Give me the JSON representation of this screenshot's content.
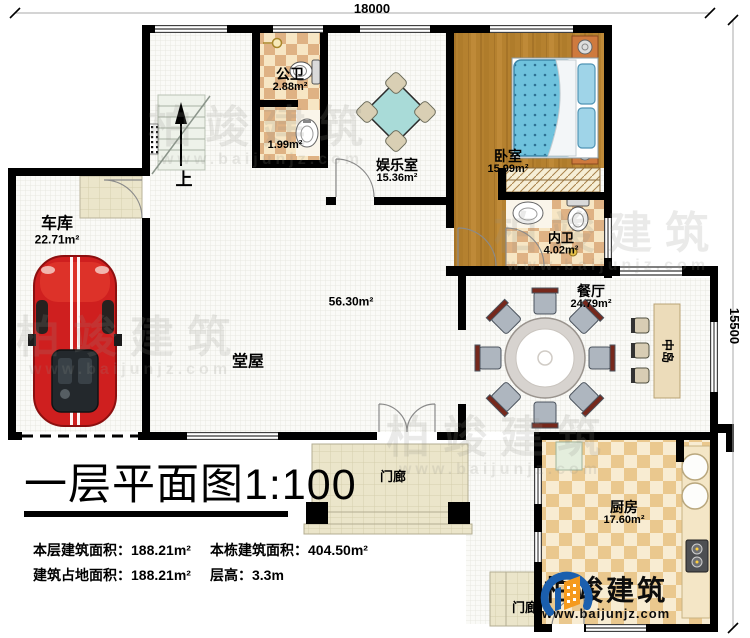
{
  "dimensions": {
    "top": "18000",
    "right": "15500"
  },
  "plan_title": {
    "text": "一层平面图",
    "scale": "1:100"
  },
  "stair": {
    "up": "上"
  },
  "rooms": {
    "garage": {
      "name": "车库",
      "area": "22.71m²"
    },
    "public_bath": {
      "name": "公卫",
      "area": "2.88m²"
    },
    "wash_alcove": {
      "area": "1.99m²"
    },
    "entertainment": {
      "name": "娱乐室",
      "area": "15.36m²"
    },
    "bedroom": {
      "name": "卧室",
      "area": "15.99m²"
    },
    "ensuite": {
      "name": "内卫",
      "area": "4.02m²"
    },
    "dining": {
      "name": "餐厅",
      "area": "24.79m²"
    },
    "hall": {
      "name": "堂屋",
      "area": "56.30m²"
    },
    "island": {
      "name": "中岛"
    },
    "kitchen": {
      "name": "厨房",
      "area": "17.60m²"
    },
    "porch_front": {
      "name": "门廊"
    },
    "porch_side": {
      "name": "门廊"
    }
  },
  "stats": {
    "floor_area": {
      "label": "本层建筑面积：",
      "value": "188.21m²"
    },
    "footprint": {
      "label": "建筑占地面积：",
      "value": "188.21m²"
    },
    "total_area": {
      "label": "本栋建筑面积：",
      "value": "404.50m²"
    },
    "story_height": {
      "label": "层高：",
      "value": "3.3m"
    }
  },
  "brand": {
    "name": "柏竣建筑",
    "url": "www.baijunjz.com"
  },
  "watermark": {
    "text": "柏竣建筑",
    "url": "www.baijunjz.com"
  },
  "colors": {
    "wall": "#000000",
    "accent_blue": "#1b5fae",
    "accent_orange": "#f59a1d",
    "car_red": "#cf1f1f",
    "bed_teal": "#6fc2dd",
    "checker_tan": "#dfb284"
  }
}
